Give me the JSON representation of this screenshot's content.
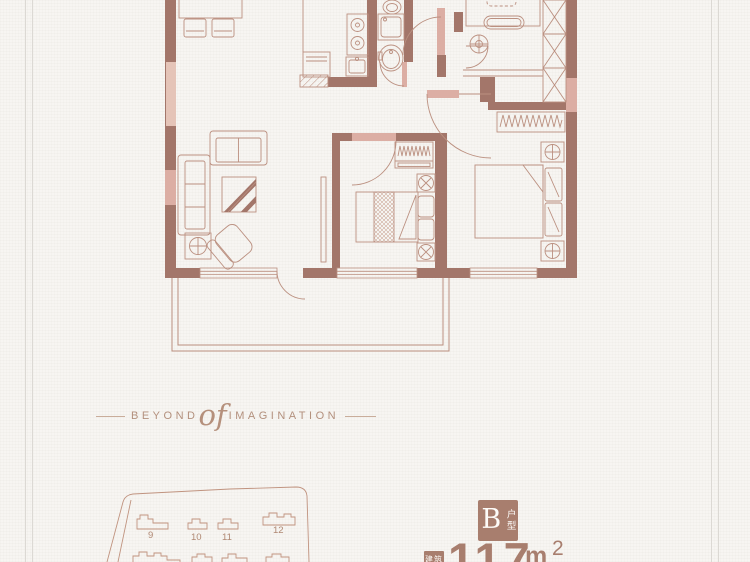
{
  "colors": {
    "background": "#f7f5f2",
    "wall": "#a3766a",
    "window_pink": "#dcaea4",
    "window_light_pink": "#e5c4b8",
    "plan_line": "#bb9080",
    "accent_brown": "#a87e6e",
    "text_taupe": "#b3907d",
    "border_line": "#dcd9d4"
  },
  "tagline": {
    "left_word": "BEYOND",
    "script_word": "of",
    "right_word": "IMAGINATION"
  },
  "unit": {
    "letter": "B",
    "type_label": "户型",
    "area_prefix": "建筑",
    "area_value": "117",
    "area_unit": "m",
    "area_sup": "2"
  },
  "site_plan": {
    "building_labels": [
      "9",
      "10",
      "11",
      "12"
    ]
  },
  "floor_plan": {
    "icons": [
      "dining-table-icon",
      "dining-chair-icon",
      "sofa-two-seat-icon",
      "sofa-three-seat-icon",
      "coffee-table-icon",
      "armchair-icon",
      "plant-stand-icon",
      "stove-icon",
      "kitchen-sink-icon",
      "counter-hatch-icon",
      "toilet-icon",
      "washing-machine-icon",
      "wash-basin-icon",
      "bed-icon",
      "nightstand-lamp-icon",
      "wardrobe-zigzag-icon",
      "wardrobe-x-icon",
      "desk-icon",
      "desk-chair-icon",
      "door-swing-icon",
      "window-icon",
      "balcony-icon"
    ]
  }
}
